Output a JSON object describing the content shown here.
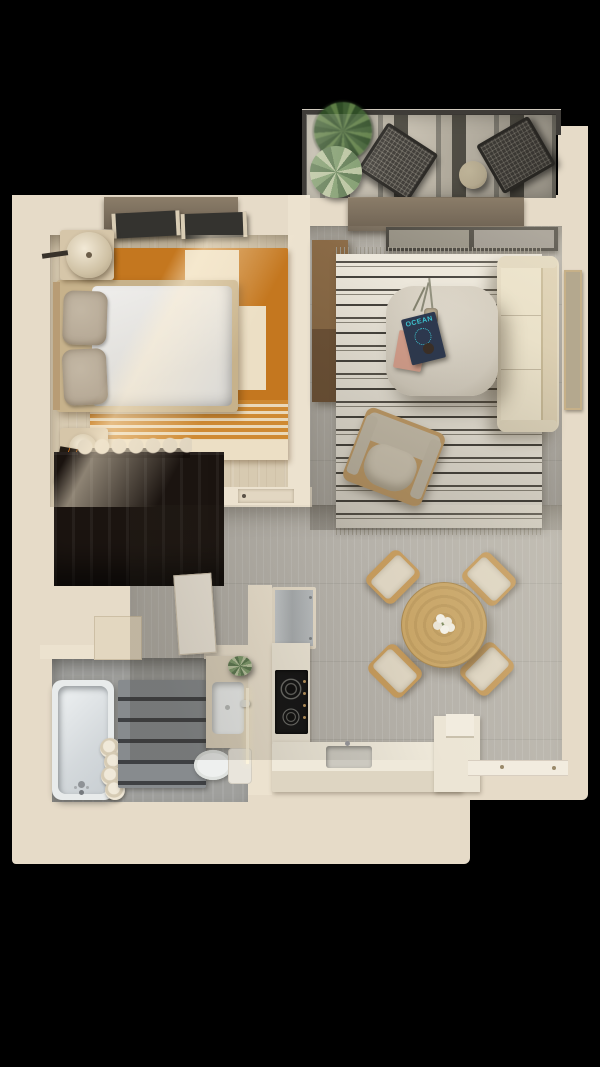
{
  "title": "One-bedroom apartment 3D floor plan, top-down render",
  "background": "black",
  "colors": {
    "bg": "#000000",
    "slab": "#e6dbc8",
    "wall": "#ece2cf",
    "lintel-top": "#8b7d69",
    "lintel-bottom": "#6e6253",
    "wood-floor": "#d7cab1",
    "rug-orange": "#c4771f",
    "rug-cream": "#ecdfc5",
    "bed-frame": "#c7b28b",
    "pillow": "#b7aa97",
    "wardrobe": "#1b1410",
    "gray-floor": "#b6b2aa",
    "rug-base": "#ece7db",
    "rug-stripe": "#57534b",
    "sofa": "#e4dac2",
    "table-cream": "#d5cec0",
    "ocean-cover": "#2d3950",
    "ocean-text": "#3ec8d6",
    "book-pink": "#d8a18e",
    "dining-wood": "#c8a567",
    "chair-wood": "#c49a5c",
    "chair-cushion": "#ddd4c1",
    "counter": "#ece5d5",
    "cooktop": "#141414",
    "bath-floor": "#a0a09d",
    "mat": "#878b8e",
    "mat-line": "#3e4043",
    "porcelain": "#eef0ef",
    "balcony-rug-light": "#ccc5b6",
    "balcony-rug-dark": "#57544b",
    "mesh-chair": "#45423d",
    "plant-dark": "#3f5e33",
    "plant-light": "#7e9a6c"
  },
  "balcony": {
    "items": [
      "striped outdoor rug",
      "mesh lounge chair",
      "mesh lounge chair",
      "round side table",
      "potted fern",
      "potted succulent",
      "glass railing"
    ]
  },
  "bedroom": {
    "items": [
      "double bed with white duvet",
      "two grey pillows",
      "headboard",
      "terracotta area rug with cream blocks and striped band",
      "round table lamp",
      "sphere bedside lamp",
      "two nightstands",
      "wall reading light",
      "double window",
      "wavy decorative bench",
      "dark wood wardrobe"
    ]
  },
  "living_room": {
    "items": [
      "striped fringe rug",
      "cream sofa",
      "wood media console",
      "balcony sliding door",
      "wall art",
      "lounge armchair",
      "coffee table with vase, branches and books"
    ],
    "coffee_table": {
      "magazine_title": "OCEAN",
      "books": [
        "navy magazine",
        "pink book"
      ],
      "decor": [
        "vase with dry branches",
        "dark cup"
      ]
    }
  },
  "dining_area": {
    "items": [
      "round wooden table",
      "white flower centerpiece",
      "four upholstered chairs with wood frames"
    ]
  },
  "kitchen": {
    "items": [
      "stainless fridge",
      "tall cream cabinets",
      "black cooktop with two burners and knobs",
      "L-shaped counter",
      "inset sink with faucet",
      "raised counter end"
    ]
  },
  "bathroom": {
    "items": [
      "bathtub with chrome faucet",
      "stack of rolled towels",
      "grey ribbed bath mat",
      "vanity with rectangular basin",
      "toilet with cistern",
      "small green plant",
      "LED wall light strip",
      "open door leaf"
    ]
  },
  "hallway": {
    "items": [
      "grey plank flooring",
      "bedroom door with handle",
      "recessed cabinet",
      "entry threshold with hardware"
    ]
  }
}
